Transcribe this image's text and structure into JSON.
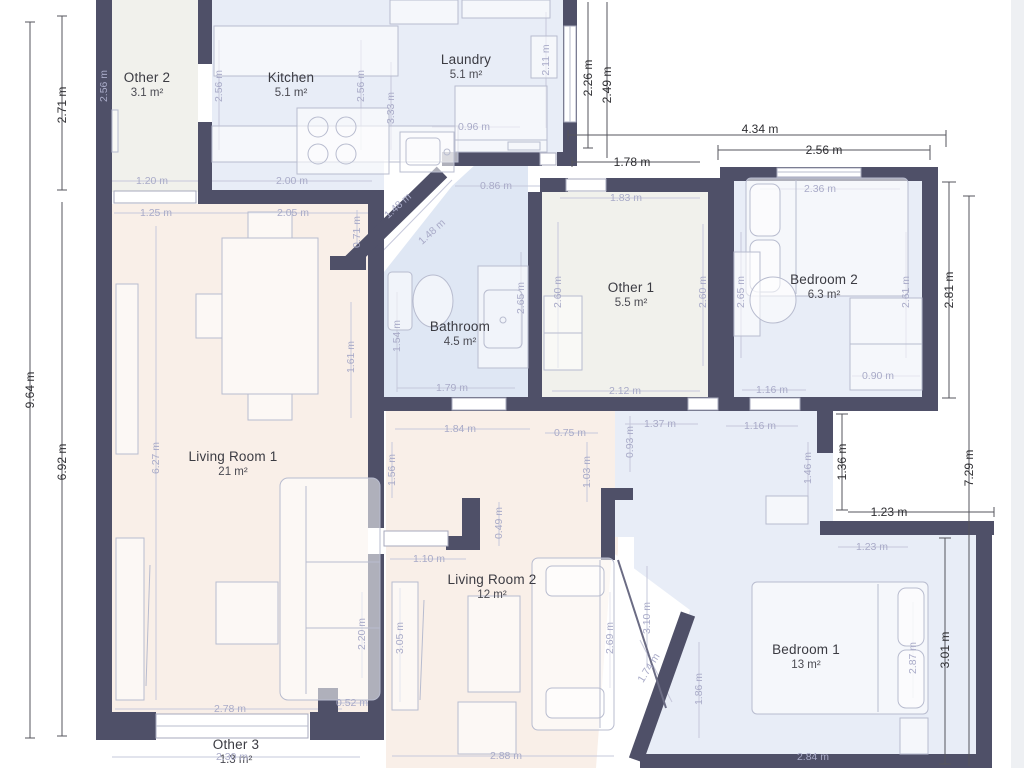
{
  "plan": {
    "colors": {
      "wall": "#4f5068",
      "blue": "#e8edf7",
      "bath": "#dfe7f4",
      "pink": "#f9efe8",
      "neutral": "#f1f1ec",
      "dim_inner": "#a9abc8",
      "dim_outer": "#2f2f33",
      "furniture": "#b8bccf"
    },
    "rooms": [
      {
        "name": "Other 2",
        "area": "3.1 m²",
        "x": 147,
        "y": 70
      },
      {
        "name": "Kitchen",
        "area": "5.1 m²",
        "x": 291,
        "y": 70
      },
      {
        "name": "Laundry",
        "area": "5.1 m²",
        "x": 466,
        "y": 52
      },
      {
        "name": "Other 1",
        "area": "5.5 m²",
        "x": 631,
        "y": 280
      },
      {
        "name": "Bedroom 2",
        "area": "6.3 m²",
        "x": 824,
        "y": 272
      },
      {
        "name": "Bathroom",
        "area": "4.5 m²",
        "x": 460,
        "y": 319
      },
      {
        "name": "Living Room 1",
        "area": "21 m²",
        "x": 233,
        "y": 449
      },
      {
        "name": "Living Room 2",
        "area": "12 m²",
        "x": 492,
        "y": 572
      },
      {
        "name": "Bedroom 1",
        "area": "13 m²",
        "x": 806,
        "y": 642
      },
      {
        "name": "Other 3",
        "area": "1.3 m²",
        "x": 236,
        "y": 737
      }
    ],
    "dims": [
      {
        "t": "2.71 m",
        "x": 62,
        "y": 105,
        "r": -90,
        "k": "o"
      },
      {
        "t": "9.64 m",
        "x": 30,
        "y": 390,
        "r": -90,
        "k": "o"
      },
      {
        "t": "6.92 m",
        "x": 62,
        "y": 462,
        "r": -90,
        "k": "o"
      },
      {
        "t": "2.26 m",
        "x": 588,
        "y": 78,
        "r": -90,
        "k": "o"
      },
      {
        "t": "2.49 m",
        "x": 607,
        "y": 85,
        "r": -90,
        "k": "o"
      },
      {
        "t": "4.34 m",
        "x": 760,
        "y": 129,
        "r": 0,
        "k": "o"
      },
      {
        "t": "1.78 m",
        "x": 632,
        "y": 162,
        "r": 0,
        "k": "o"
      },
      {
        "t": "2.56 m",
        "x": 824,
        "y": 150,
        "r": 0,
        "k": "o"
      },
      {
        "t": "2.81 m",
        "x": 949,
        "y": 290,
        "r": -90,
        "k": "o"
      },
      {
        "t": "7.29 m",
        "x": 969,
        "y": 468,
        "r": -90,
        "k": "o"
      },
      {
        "t": "1.36 m",
        "x": 842,
        "y": 462,
        "r": -90,
        "k": "o"
      },
      {
        "t": "1.23 m",
        "x": 889,
        "y": 512,
        "r": 0,
        "k": "o"
      },
      {
        "t": "3.01 m",
        "x": 945,
        "y": 650,
        "r": -90,
        "k": "o"
      },
      {
        "t": "2.56 m",
        "x": 104,
        "y": 86,
        "r": -90,
        "k": "i"
      },
      {
        "t": "2.56 m",
        "x": 219,
        "y": 86,
        "r": -90,
        "k": "i"
      },
      {
        "t": "2.56 m",
        "x": 361,
        "y": 86,
        "r": -90,
        "k": "i"
      },
      {
        "t": "3.33 m",
        "x": 391,
        "y": 108,
        "r": -90,
        "k": "i"
      },
      {
        "t": "2.11 m",
        "x": 546,
        "y": 60,
        "r": -90,
        "k": "i"
      },
      {
        "t": "1.20 m",
        "x": 152,
        "y": 181,
        "r": 0,
        "k": "i"
      },
      {
        "t": "2.00 m",
        "x": 292,
        "y": 181,
        "r": 0,
        "k": "i"
      },
      {
        "t": "1.25 m",
        "x": 156,
        "y": 213,
        "r": 0,
        "k": "i"
      },
      {
        "t": "2.05 m",
        "x": 293,
        "y": 213,
        "r": 0,
        "k": "i"
      },
      {
        "t": "0.96 m",
        "x": 474,
        "y": 127,
        "r": 0,
        "k": "i"
      },
      {
        "t": "0.86 m",
        "x": 496,
        "y": 186,
        "r": 0,
        "k": "i"
      },
      {
        "t": "1.48 m",
        "x": 398,
        "y": 206,
        "r": -42,
        "k": "i"
      },
      {
        "t": "1.48 m",
        "x": 432,
        "y": 232,
        "r": -42,
        "k": "i"
      },
      {
        "t": "1.83 m",
        "x": 626,
        "y": 198,
        "r": 0,
        "k": "i"
      },
      {
        "t": "2.60 m",
        "x": 558,
        "y": 292,
        "r": -90,
        "k": "i"
      },
      {
        "t": "2.60 m",
        "x": 703,
        "y": 292,
        "r": -90,
        "k": "i"
      },
      {
        "t": "2.65 m",
        "x": 741,
        "y": 292,
        "r": -90,
        "k": "i"
      },
      {
        "t": "2.36 m",
        "x": 820,
        "y": 189,
        "r": 0,
        "k": "i"
      },
      {
        "t": "2.61 m",
        "x": 906,
        "y": 292,
        "r": -90,
        "k": "i"
      },
      {
        "t": "0.90 m",
        "x": 878,
        "y": 376,
        "r": 0,
        "k": "i"
      },
      {
        "t": "1.54 m",
        "x": 397,
        "y": 336,
        "r": -90,
        "k": "i"
      },
      {
        "t": "2.65 m",
        "x": 521,
        "y": 298,
        "r": -90,
        "k": "i"
      },
      {
        "t": "0.71 m",
        "x": 357,
        "y": 232,
        "r": -90,
        "k": "i"
      },
      {
        "t": "1.61 m",
        "x": 351,
        "y": 357,
        "r": -90,
        "k": "i"
      },
      {
        "t": "6.27 m",
        "x": 156,
        "y": 458,
        "r": -90,
        "k": "i"
      },
      {
        "t": "1.79 m",
        "x": 452,
        "y": 388,
        "r": 0,
        "k": "i"
      },
      {
        "t": "2.12 m",
        "x": 625,
        "y": 391,
        "r": 0,
        "k": "i"
      },
      {
        "t": "1.16 m",
        "x": 772,
        "y": 390,
        "r": 0,
        "k": "i"
      },
      {
        "t": "1.16 m",
        "x": 760,
        "y": 426,
        "r": 0,
        "k": "i"
      },
      {
        "t": "1.84 m",
        "x": 460,
        "y": 429,
        "r": 0,
        "k": "i"
      },
      {
        "t": "0.75 m",
        "x": 570,
        "y": 433,
        "r": 0,
        "k": "i"
      },
      {
        "t": "1.03 m",
        "x": 587,
        "y": 472,
        "r": -90,
        "k": "i"
      },
      {
        "t": "0.93 m",
        "x": 630,
        "y": 442,
        "r": -90,
        "k": "i"
      },
      {
        "t": "1.37 m",
        "x": 660,
        "y": 424,
        "r": 0,
        "k": "i"
      },
      {
        "t": "1.46 m",
        "x": 808,
        "y": 468,
        "r": -90,
        "k": "i"
      },
      {
        "t": "1.23 m",
        "x": 872,
        "y": 547,
        "r": 0,
        "k": "i"
      },
      {
        "t": "0.49 m",
        "x": 499,
        "y": 523,
        "r": -90,
        "k": "i"
      },
      {
        "t": "1.10 m",
        "x": 429,
        "y": 559,
        "r": 0,
        "k": "i"
      },
      {
        "t": "1.56 m",
        "x": 392,
        "y": 470,
        "r": -90,
        "k": "i"
      },
      {
        "t": "3.05 m",
        "x": 400,
        "y": 638,
        "r": -90,
        "k": "i"
      },
      {
        "t": "2.20 m",
        "x": 362,
        "y": 634,
        "r": -90,
        "k": "i"
      },
      {
        "t": "2.69 m",
        "x": 610,
        "y": 638,
        "r": -90,
        "k": "i"
      },
      {
        "t": "3.10 m",
        "x": 647,
        "y": 618,
        "r": -90,
        "k": "i"
      },
      {
        "t": "1.74 m",
        "x": 649,
        "y": 668,
        "r": -58,
        "k": "i"
      },
      {
        "t": "1.86 m",
        "x": 699,
        "y": 689,
        "r": -90,
        "k": "i"
      },
      {
        "t": "2.78 m",
        "x": 230,
        "y": 709,
        "r": 0,
        "k": "i"
      },
      {
        "t": "0.52 m",
        "x": 352,
        "y": 703,
        "r": 0,
        "k": "i"
      },
      {
        "t": "2.30 m",
        "x": 232,
        "y": 757,
        "r": 0,
        "k": "i"
      },
      {
        "t": "2.88 m",
        "x": 506,
        "y": 756,
        "r": 0,
        "k": "i"
      },
      {
        "t": "2.84 m",
        "x": 813,
        "y": 757,
        "r": 0,
        "k": "i"
      },
      {
        "t": "2.87 m",
        "x": 913,
        "y": 658,
        "r": -90,
        "k": "i"
      }
    ]
  }
}
